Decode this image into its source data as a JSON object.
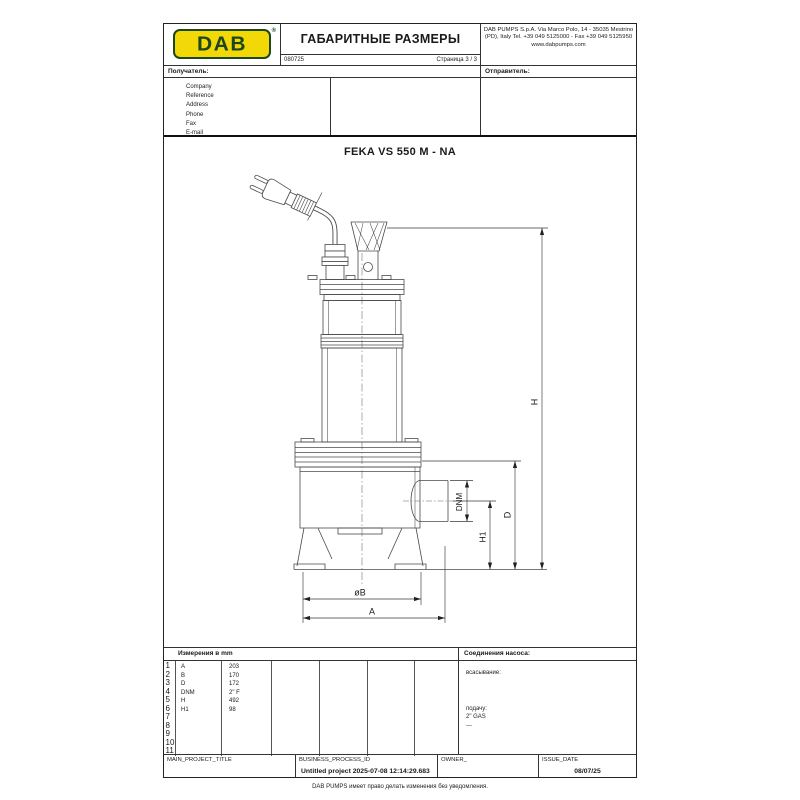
{
  "header": {
    "logo_text": "DAB",
    "logo_reg": "®",
    "title": "ГАБАРИТНЫЕ РАЗМЕРЫ",
    "doc_number": "080725",
    "page_label": "Страница 3 / 3",
    "company_lines": [
      "DAB PUMPS S.p.A.",
      "Via Marco Polo, 14 - 35035 Mestrino (PD), Italy",
      "Tel. +39 049 5125000 - Fax +39 049 5125950",
      "www.dabpumps.com"
    ],
    "recipient_label": "Получатель:",
    "sender_label": "Отправитель:"
  },
  "customer_fields": [
    "Company",
    "Reference",
    "Address",
    "Phone",
    "Fax",
    "E-mail"
  ],
  "drawing": {
    "model": "FEKA VS 550 M - NA",
    "dims": {
      "h": "H",
      "d": "D",
      "h1": "H1",
      "dnm": "DNM",
      "b": "øB",
      "a": "A"
    }
  },
  "measurements": {
    "title": "Измерения в  mm",
    "row_numbers": [
      "1",
      "2",
      "3",
      "4",
      "5",
      "6",
      "7",
      "8",
      "9",
      "10",
      "11"
    ],
    "rows": [
      {
        "label": "A",
        "value": "203"
      },
      {
        "label": "B",
        "value": "170"
      },
      {
        "label": "D",
        "value": "172"
      },
      {
        "label": "DNM",
        "value": "2\" F"
      },
      {
        "label": "H",
        "value": "492"
      },
      {
        "label": "H1",
        "value": "98"
      }
    ]
  },
  "connections": {
    "title": "Соединения насоса:",
    "suction_label": "всасывание:",
    "delivery_label": "подачу:",
    "delivery_value": "2\" GAS",
    "delivery_note": "---"
  },
  "footer": {
    "project_title_label": "MAIN_PROJECT_TITLE",
    "process_id_label": "BUSINESS_PROCESS_ID",
    "process_id_value": "Untitled project 2025-07-08 12:14:29.683",
    "owner_label": "OWNER_",
    "issue_date_label": "ISSUE_DATE",
    "issue_date_value": "08/07/25",
    "disclaimer": "DAB PUMPS имеет право делать изменения без уведомления."
  },
  "colors": {
    "logo_yellow": "#f2d806",
    "logo_green": "#1d461d",
    "line": "#333333"
  }
}
